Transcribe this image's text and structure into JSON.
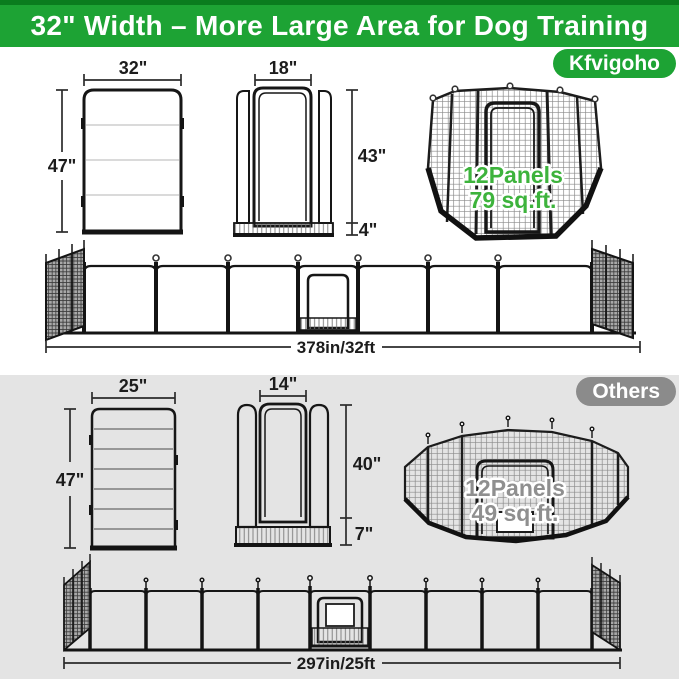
{
  "header": {
    "title": "32\" Width – More Large Area for Dog Training",
    "brand_badge": "Kfvigoho"
  },
  "brand": {
    "panel_width": "32\"",
    "panel_height": "47\"",
    "door_width": "18\"",
    "door_height": "43\"",
    "bottom_bar_height": "4\"",
    "pen_line1": "12Panels",
    "pen_line2": "79 sq.ft.",
    "row_length": "378in/32ft"
  },
  "others": {
    "badge_label": "Others",
    "panel_width": "25\"",
    "panel_height": "47\"",
    "door_width": "14\"",
    "door_height": "40\"",
    "bottom_bar_height": "7\"",
    "pen_line1": "12Panels",
    "pen_line2": "49 sq.ft.",
    "row_length": "297in/25ft"
  },
  "colors": {
    "header_green": "#1da334",
    "header_dark_green": "#0a7c1e",
    "others_gray": "#8b8b8b",
    "pen_label_green": "#3db33c",
    "pen_label_gray": "#8f8f8f",
    "bottom_section_bg": "#e4e4e4",
    "line_color": "#1c1c1c"
  }
}
